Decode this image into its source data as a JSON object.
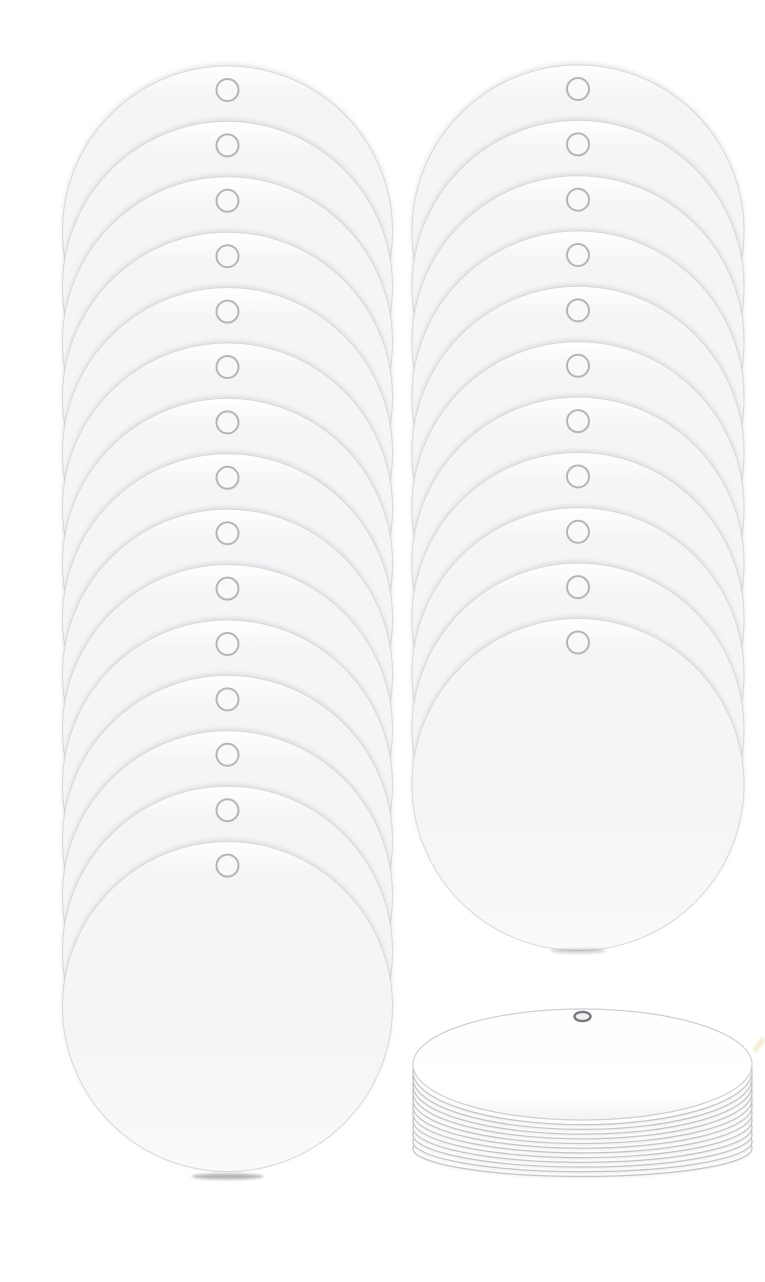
{
  "scene": {
    "type": "product-photo",
    "subject": "blank-round-disc-ornaments-with-hole",
    "background_color": "#ffffff",
    "canvas": {
      "width": 765,
      "height": 1282
    },
    "colors": {
      "disc_rim_highlight": "#ffffff",
      "disc_fill": "#f5f5f7",
      "disc_fill_bottom": "#fafafb",
      "disc_edge": "#d8d8db",
      "hole_ring": "#b5b5b9",
      "hole_fill": "#f9f9fa",
      "side_fill": "#fdfdfe",
      "side_edge": "#c4c4c8",
      "side_top_fill": "#fefeff",
      "side_top_edge": "#cfcfd3",
      "side_hole_ring": "#77777c",
      "side_hole_fill": "#f0f0f2",
      "contact_shadow": "#6e6e73",
      "artifact_speck": "#e9daa5"
    },
    "stacks": [
      {
        "name": "left-fanned-stack",
        "style": "fanned-vertical",
        "disc_count": 15,
        "disc_radius": 165,
        "center_x": 227.5,
        "first_center_y": 231,
        "step_y": 55.4,
        "hole_radius": 11,
        "hole_center_below_top_edge": 24,
        "ground_shadow": {
          "cx": 227.5,
          "cy": 1176.5,
          "rx": 36,
          "ry": 3,
          "opacity": 0.5
        }
      },
      {
        "name": "right-fanned-stack",
        "style": "fanned-vertical",
        "disc_count": 11,
        "disc_radius": 166,
        "center_x": 578,
        "first_center_y": 231,
        "step_y": 55.35,
        "hole_radius": 11,
        "hole_center_below_top_edge": 24,
        "ground_shadow": {
          "cx": 578,
          "cy": 951,
          "rx": 28,
          "ry": 2.5,
          "opacity": 0.3
        }
      },
      {
        "name": "side-view-stack",
        "style": "horizontal-pile",
        "disc_count": 13,
        "center_x": 582.5,
        "top_center_y": 1064.5,
        "rx": 169.5,
        "ry": 55.5,
        "layer_step_cy": 7.0,
        "layer_step_ry": -2.3,
        "hole": {
          "cx": 582.5,
          "cy": 1016.5,
          "rx": 8,
          "ry": 4.6
        }
      }
    ],
    "artifact_speck": {
      "x": 756.5,
      "y": 1037,
      "width": 5,
      "height": 16,
      "rotation": 35,
      "opacity": 0.55
    }
  }
}
